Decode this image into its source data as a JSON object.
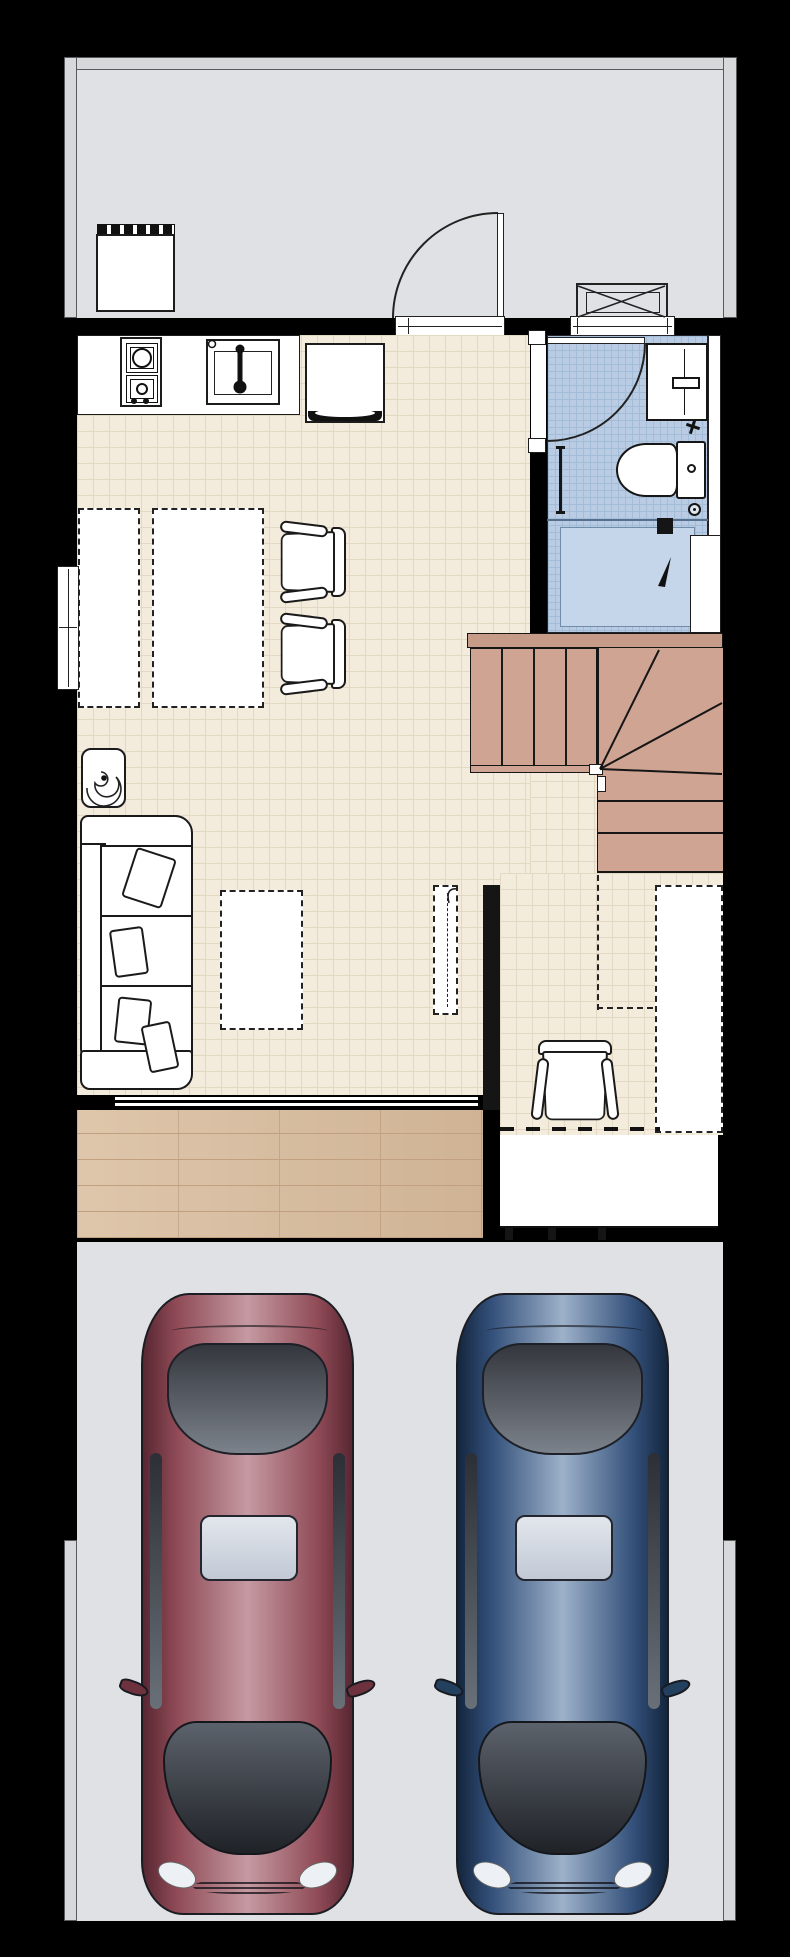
{
  "document": {
    "type": "architectural floor plan",
    "view": "top-down ground floor with driveway",
    "canvas": {
      "width": 790,
      "height": 1957
    }
  },
  "colors": {
    "patio": "#e0e1e4",
    "patioWall": "#d7d8da",
    "beige": "#f3ecdc",
    "beigeLine": "#e3d9c3",
    "blue": "#b9cce3",
    "blueLine": "#a3bcd8",
    "tan": "#cfa492",
    "tanDark": "#c69b87",
    "deck": "#d9bd9e",
    "deckLine": "#c0a07e",
    "drive": "#e0e1e4",
    "carRed": "#8f4a56",
    "carBlue": "#33507a"
  },
  "rooms": [
    {
      "id": "patio",
      "name": "rear patio"
    },
    {
      "id": "kitchen",
      "name": "kitchen"
    },
    {
      "id": "dining",
      "name": "dining area"
    },
    {
      "id": "living",
      "name": "living room"
    },
    {
      "id": "bathroom",
      "name": "bathroom"
    },
    {
      "id": "washroom",
      "name": "washroom"
    },
    {
      "id": "stairs",
      "name": "staircase"
    },
    {
      "id": "foyer",
      "name": "entry foyer"
    },
    {
      "id": "porch",
      "name": "entrance porch"
    },
    {
      "id": "deck",
      "name": "wood deck"
    },
    {
      "id": "driveway",
      "name": "driveway"
    }
  ],
  "fixtures": [
    {
      "id": "refrigerator",
      "room": "patio"
    },
    {
      "id": "ac-outdoor-unit",
      "room": "patio"
    },
    {
      "id": "back-door",
      "room": "patio"
    },
    {
      "id": "gas-stove",
      "room": "kitchen"
    },
    {
      "id": "kitchen-sink",
      "room": "kitchen"
    },
    {
      "id": "under-counter-appliance",
      "room": "kitchen"
    },
    {
      "id": "dining-table-planned-left",
      "room": "dining"
    },
    {
      "id": "dining-table-planned-right",
      "room": "dining"
    },
    {
      "id": "dining-chair-1",
      "room": "dining"
    },
    {
      "id": "dining-chair-2",
      "room": "dining"
    },
    {
      "id": "potted-plant",
      "room": "living"
    },
    {
      "id": "sofa",
      "room": "living"
    },
    {
      "id": "coffee-table-planned",
      "room": "living"
    },
    {
      "id": "tv-planned",
      "room": "living"
    },
    {
      "id": "shower-unit",
      "room": "bathroom"
    },
    {
      "id": "toilet",
      "room": "bathroom"
    },
    {
      "id": "towel-rail",
      "room": "bathroom"
    },
    {
      "id": "shutoff-valve",
      "room": "bathroom"
    },
    {
      "id": "floor-drain",
      "room": "bathroom"
    },
    {
      "id": "bathroom-door",
      "room": "bathroom"
    },
    {
      "id": "washroom-door",
      "room": "washroom"
    },
    {
      "id": "understair-storage-planned",
      "room": "foyer"
    },
    {
      "id": "armchair",
      "room": "foyer"
    },
    {
      "id": "left-wall-window",
      "room": "dining"
    },
    {
      "id": "bathroom-window",
      "room": "bathroom"
    },
    {
      "id": "sliding-door",
      "room": "living"
    }
  ],
  "vehicles": [
    {
      "id": "red-car",
      "name": "red sedan",
      "color": "#8f4a56"
    },
    {
      "id": "blue-car",
      "name": "blue sedan",
      "color": "#33507a"
    }
  ]
}
